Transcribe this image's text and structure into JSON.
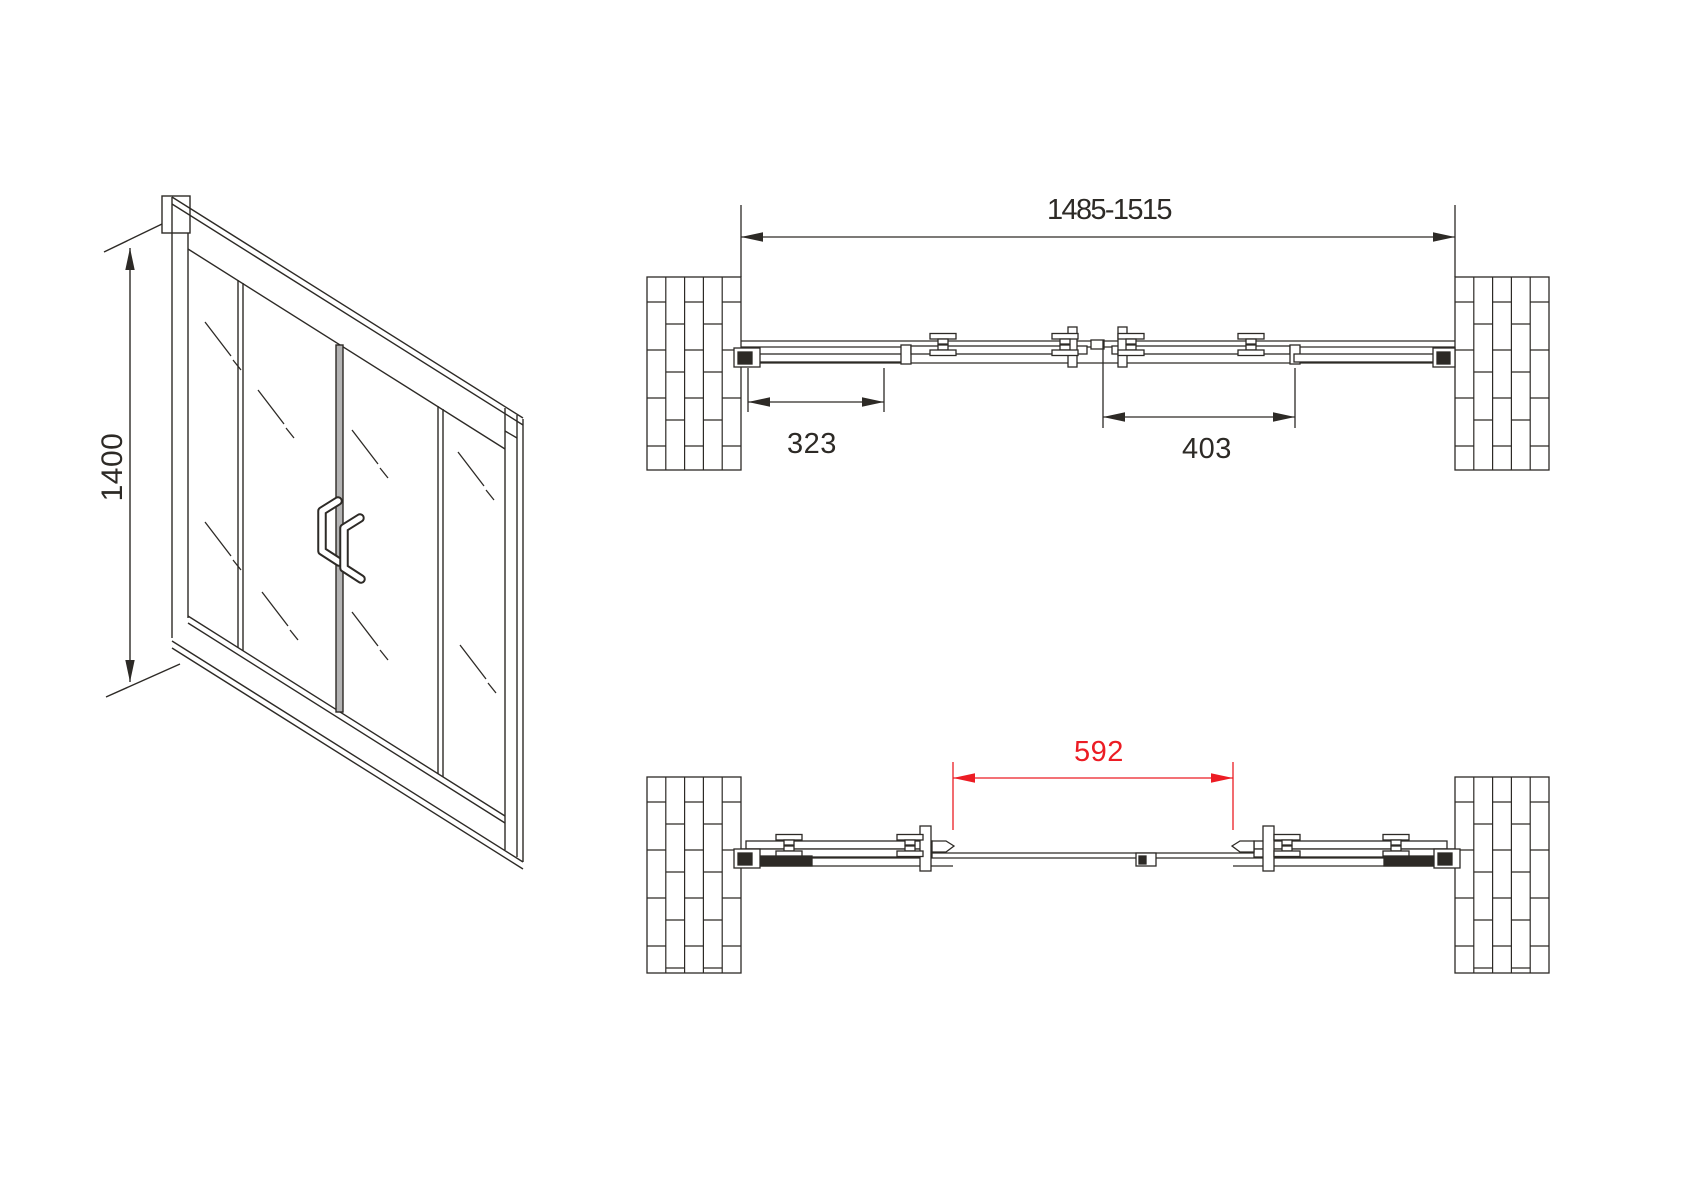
{
  "colors": {
    "line": "#2d2a26",
    "accent_red": "#ec1c24",
    "background": "#ffffff",
    "stile_fill": "#b3b3b3"
  },
  "iso_view": {
    "height_label": "1400"
  },
  "plan_closed": {
    "overall_label": "1485-1515",
    "left_offset_label": "323",
    "right_offset_label": "403"
  },
  "plan_open": {
    "opening_label": "592"
  }
}
